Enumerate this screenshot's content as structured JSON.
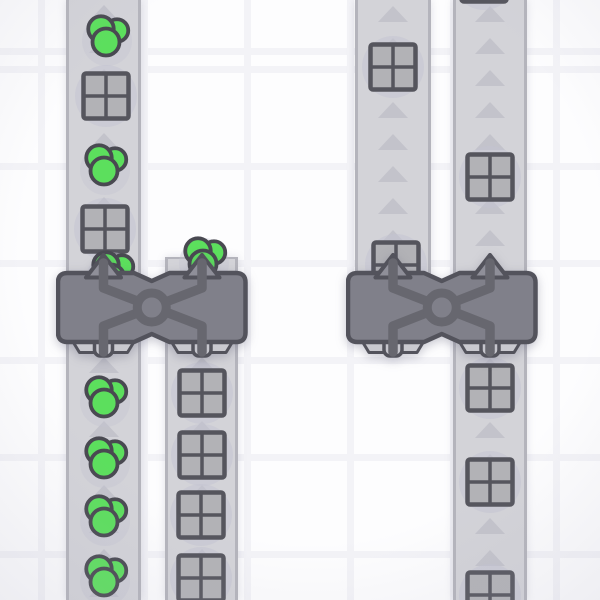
{
  "scene": {
    "description": "factory-automation-game-viewport",
    "colors": {
      "background": "#fdfdfe",
      "grid_line": "#f3f3f7",
      "belt_fill": "#d3d3d8",
      "belt_edge": "#b4b4bc",
      "belt_arrow": "#c3c3cb",
      "item_halo": "#c4c4d2",
      "crate_fill": "#b2b2b6",
      "crate_stroke": "#55555d",
      "berry_fill": "#5cdf5d",
      "berry_stroke": "#494951",
      "machine_body": "#80808a",
      "machine_outline": "#53535c",
      "machine_pipe": "#67676f",
      "machine_arrow": "#8f8f99",
      "machine_platform": "#c9c9cf",
      "machine_stub": "#c5c5cc"
    },
    "belt_arrow_spacing": 32,
    "machine_row_gap": [
      252,
      362
    ],
    "belts": [
      {
        "id": "belt-left-1",
        "x": 66,
        "width": 75,
        "top": 0,
        "bottom": 600,
        "arrow_start": 13,
        "cap_top": false
      },
      {
        "id": "belt-left-2",
        "x": 165,
        "width": 73,
        "top": 257,
        "bottom": 600,
        "arrow_start": 365,
        "cap_top": true
      },
      {
        "id": "belt-right-1",
        "x": 355,
        "width": 76,
        "top": 0,
        "bottom": 278,
        "arrow_start": 14,
        "cap_top": false
      },
      {
        "id": "belt-right-2",
        "x": 453,
        "width": 74,
        "top": 0,
        "bottom": 600,
        "arrow_start": 14,
        "cap_top": false
      }
    ],
    "items": [
      {
        "type": "circle-cluster",
        "x": 107,
        "y": 35
      },
      {
        "type": "square-crate",
        "x": 106,
        "y": 96
      },
      {
        "type": "circle-cluster",
        "x": 105,
        "y": 164
      },
      {
        "type": "square-crate",
        "x": 105,
        "y": 229
      },
      {
        "type": "circle-cluster",
        "x": 112,
        "y": 271
      },
      {
        "type": "circle-cluster",
        "x": 204,
        "y": 257
      },
      {
        "type": "circle-cluster",
        "x": 105,
        "y": 396
      },
      {
        "type": "circle-cluster",
        "x": 105,
        "y": 457
      },
      {
        "type": "circle-cluster",
        "x": 105,
        "y": 515
      },
      {
        "type": "circle-cluster",
        "x": 105,
        "y": 575
      },
      {
        "type": "square-crate",
        "x": 202,
        "y": 393
      },
      {
        "type": "square-crate",
        "x": 202,
        "y": 455
      },
      {
        "type": "square-crate",
        "x": 201,
        "y": 515
      },
      {
        "type": "square-crate",
        "x": 201,
        "y": 578
      },
      {
        "type": "square-crate",
        "x": 393,
        "y": 67
      },
      {
        "type": "square-crate",
        "x": 396,
        "y": 265
      },
      {
        "type": "square-crate",
        "x": 484,
        "y": -21
      },
      {
        "type": "square-crate",
        "x": 490,
        "y": 177
      },
      {
        "type": "square-crate",
        "x": 490,
        "y": 388
      },
      {
        "type": "square-crate",
        "x": 490,
        "y": 482
      },
      {
        "type": "square-crate",
        "x": 490,
        "y": 595
      }
    ],
    "machines": [
      {
        "id": "balancer-left",
        "x": 56,
        "y": 250,
        "inputs_x": [
          47.5,
          146
        ]
      },
      {
        "id": "balancer-right",
        "x": 346,
        "y": 250,
        "inputs_x": [
          47,
          144
        ]
      }
    ]
  }
}
